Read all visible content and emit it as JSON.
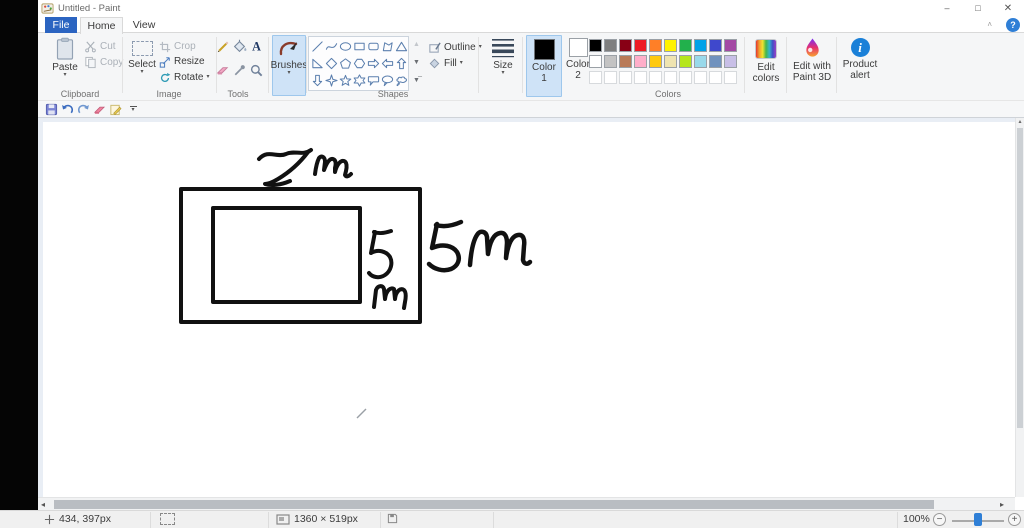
{
  "window": {
    "title": "Untitled - Paint"
  },
  "tabs": {
    "file": "File",
    "home": "Home",
    "view": "View"
  },
  "quick_access_icons": [
    "save",
    "undo",
    "redo",
    "eraser",
    "edit-document",
    "customize-toolbar"
  ],
  "ribbon": {
    "clipboard": {
      "group_label": "Clipboard",
      "paste_label": "Paste",
      "cut_label": "Cut",
      "copy_label": "Copy"
    },
    "image": {
      "group_label": "Image",
      "select_label": "Select",
      "crop_label": "Crop",
      "resize_label": "Resize",
      "rotate_label": "Rotate"
    },
    "tools": {
      "group_label": "Tools",
      "icons": [
        "pencil",
        "fill-with-color",
        "text",
        "eraser",
        "color-picker",
        "magnifier"
      ]
    },
    "brushes": {
      "label": "Brushes",
      "selected": true
    },
    "shapes": {
      "group_label": "Shapes",
      "outline_label": "Outline",
      "fill_label": "Fill",
      "icons": [
        "line",
        "curve",
        "oval",
        "rectangle",
        "rounded-rectangle",
        "polygon",
        "triangle",
        "right-triangle",
        "diamond",
        "pentagon",
        "hexagon",
        "arrow-right",
        "arrow-left",
        "arrow-up",
        "arrow-down",
        "four-point-star",
        "five-point-star",
        "six-point-star",
        "rounded-callout",
        "oval-callout",
        "cloud-callout"
      ]
    },
    "size": {
      "label": "Size"
    },
    "colors": {
      "group_label": "Colors",
      "color1_label": "Color 1",
      "color2_label": "Color 2",
      "color1_value": "#000000",
      "color2_value": "#ffffff",
      "palette": [
        [
          "#000000",
          "#7f7f7f",
          "#880015",
          "#ed1c24",
          "#ff7f27",
          "#fff200",
          "#22b14c",
          "#00a2e8",
          "#3f48cc",
          "#a349a4"
        ],
        [
          "#ffffff",
          "#c3c3c3",
          "#b97a57",
          "#ffaec9",
          "#ffc90e",
          "#efe4b0",
          "#b5e61d",
          "#99d9ea",
          "#7092be",
          "#c8bfe7"
        ]
      ],
      "empty_custom_slots": 10,
      "edit_colors_label": "Edit colors",
      "edit_with_paint3d_label": "Edit with Paint 3D",
      "product_alert_label": "Product alert"
    }
  },
  "canvas": {
    "drawing": {
      "shapes": [
        {
          "name": "outer-rectangle"
        },
        {
          "name": "inner-rectangle"
        }
      ],
      "annotations": [
        {
          "text": "7m",
          "location": "above outer rectangle top edge"
        },
        {
          "text": "5 m",
          "location": "right of inner rectangle"
        },
        {
          "text": "5 m",
          "location": "right of outer rectangle"
        }
      ]
    }
  },
  "status_bar": {
    "cursor_position": "434, 397px",
    "selection_size": "",
    "image_size": "1360 × 519px",
    "file_size": "",
    "zoom_level": "100%"
  }
}
